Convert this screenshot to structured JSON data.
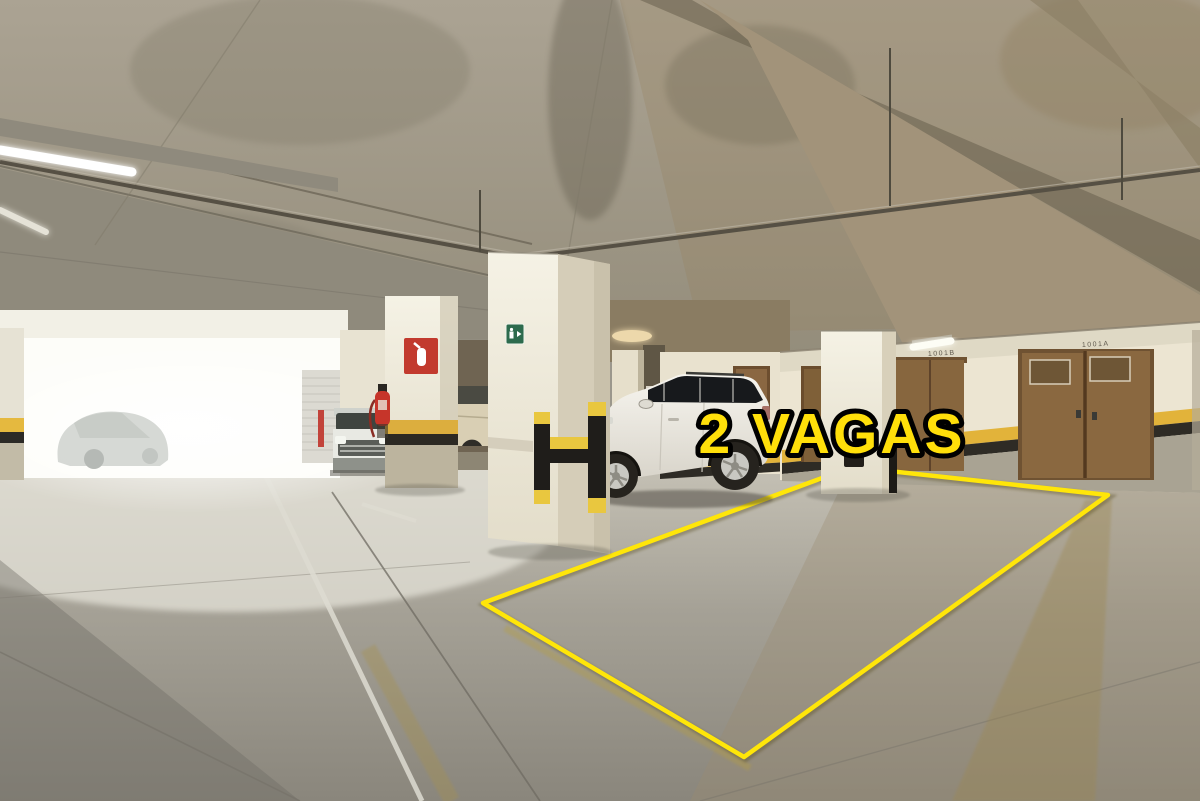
{
  "image": {
    "width": 1200,
    "height": 801
  },
  "overlay": {
    "label": "2 VAGAS",
    "text_fill": "#ffdf0a",
    "text_outline": "#000000"
  },
  "parking_outline": {
    "stroke": "#ffe609",
    "stroke_width": "4.5",
    "points_str": "852,467 1108,495 744,757 483,603"
  },
  "signs": {
    "stencil_left": "1001B",
    "stencil_right": "1001A",
    "exit_sign_color": "#2d6b4d",
    "extinguisher_sign_color": "#c23a2e"
  },
  "palette": {
    "ceiling_concrete": "#a49c8a",
    "beam_shadow": "#625a48",
    "wall_cream": "#ece5d2",
    "stripe_yellow": "#e2b33a",
    "stripe_black": "#2e2b25",
    "door_wood": "#8a6840",
    "floor_concrete": "#9b978c",
    "suv_white": "#f2f0ea",
    "guard_yellow": "#e9c73f",
    "guard_black": "#1f1d1a",
    "extinguisher_red": "#c6352a",
    "daylight_white": "#fdfdf9"
  }
}
